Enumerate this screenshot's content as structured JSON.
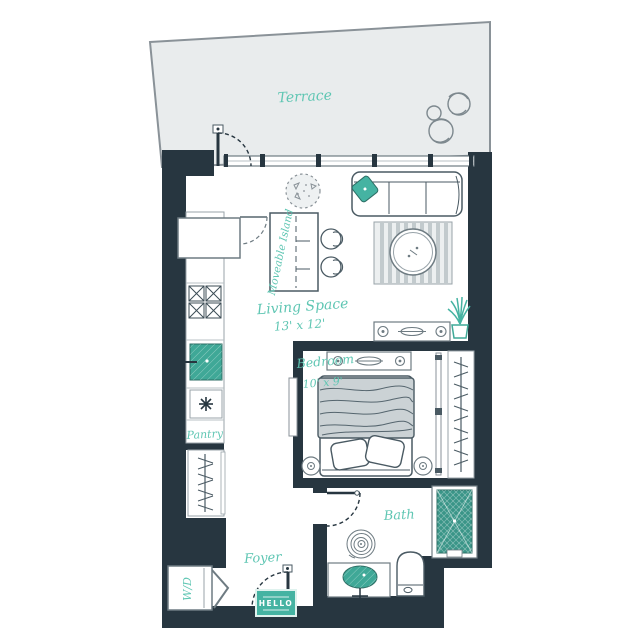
{
  "rooms": {
    "terrace": "Terrace",
    "living_space": {
      "name": "Living Space",
      "dims": "13' x 12'"
    },
    "bedroom": {
      "name": "Bedroom",
      "dims": "10' x 9'"
    },
    "bath": "Bath",
    "foyer": "Foyer",
    "pantry": "Pantry"
  },
  "features": {
    "island": "Moveable Island",
    "washer_dryer": "W/D",
    "door_mat": "HELLO"
  },
  "colors": {
    "wall": "#273640",
    "accent_teal": "#45b3a2",
    "shower_teal": "#3a9588",
    "label_teal": "#5fc6b3",
    "terrace_fill": "#e9eced",
    "furniture_outline": "#4a5a63",
    "light_outline": "#98a3a9"
  }
}
